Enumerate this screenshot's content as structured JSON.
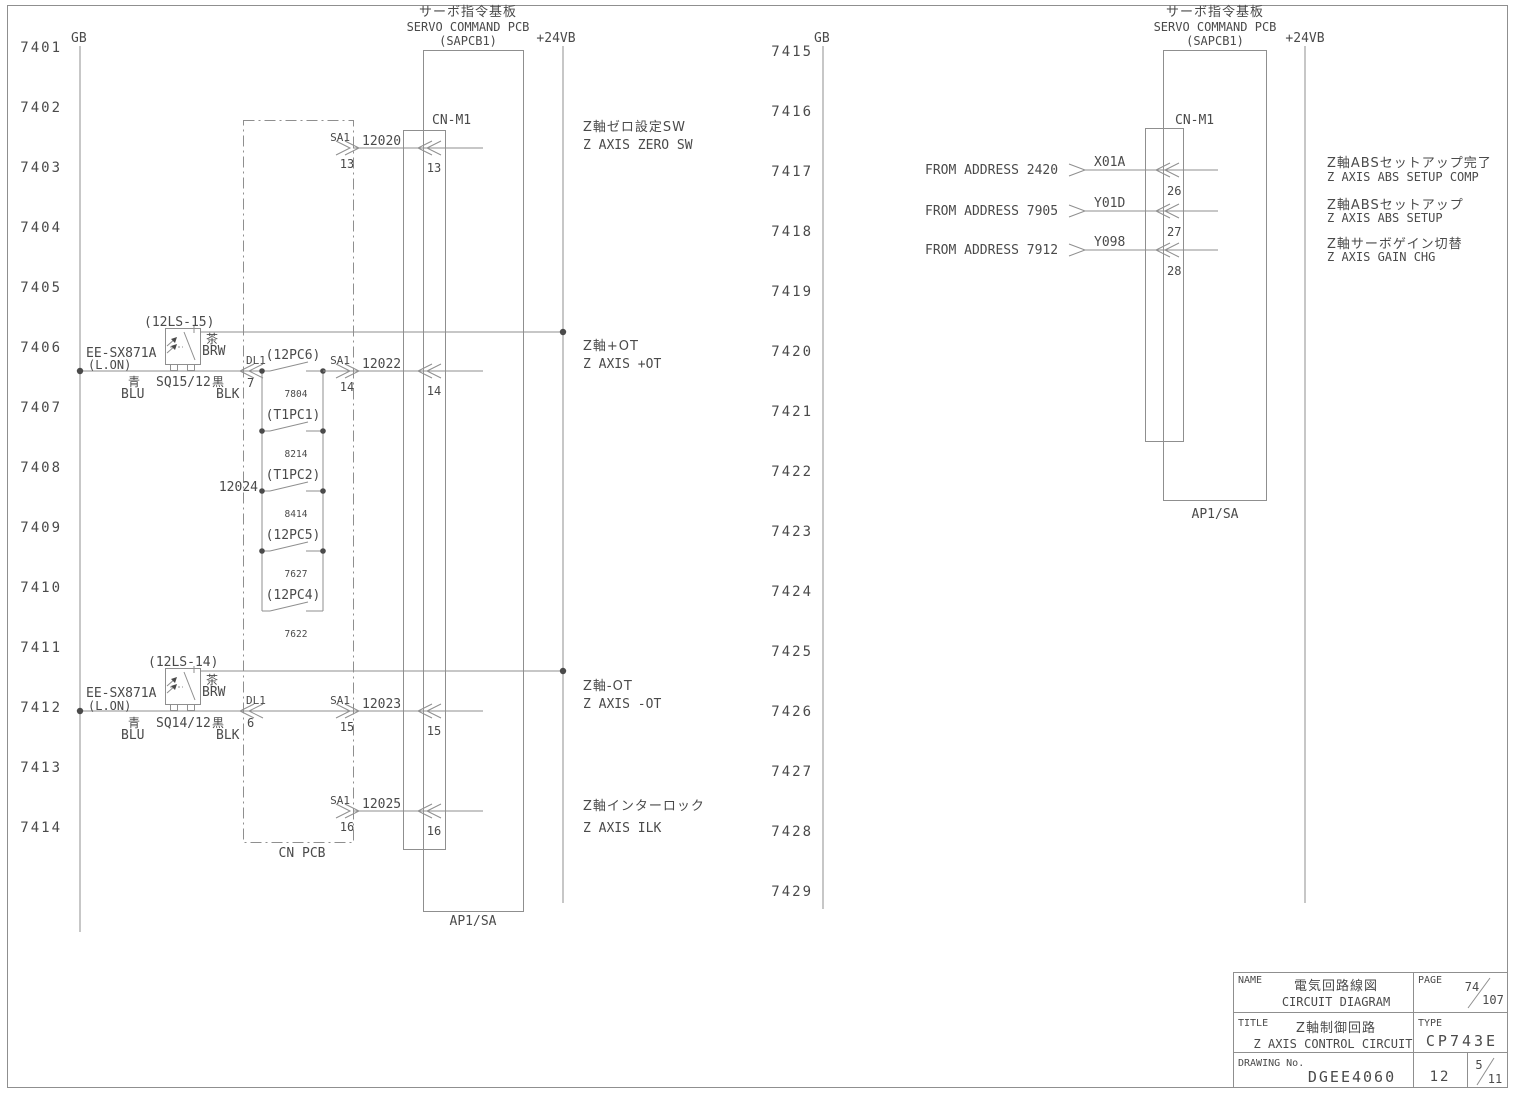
{
  "drawing": {
    "left_rows": [
      "7401",
      "7402",
      "7403",
      "7404",
      "7405",
      "7406",
      "7407",
      "7408",
      "7409",
      "7410",
      "7411",
      "7412",
      "7413",
      "7414"
    ],
    "right_rows": [
      "7415",
      "7416",
      "7417",
      "7418",
      "7419",
      "7420",
      "7421",
      "7422",
      "7423",
      "7424",
      "7425",
      "7426",
      "7427",
      "7428",
      "7429"
    ],
    "gb_label": "GB",
    "v24_label": "+24VB",
    "pcb_title_jp": "サーボ指令基板",
    "pcb_title_en": "SERVO COMMAND PCB",
    "pcb_title_sub": "(SAPCB1)",
    "connector_label": "CN-M1",
    "pcb_bottom_label": "AP1/SA",
    "cn_pcb_label": "CN PCB",
    "colors": {
      "line": "#8f8f8f",
      "text": "#4a4a4a"
    }
  },
  "left": {
    "signals": [
      {
        "conn": "SA1",
        "pin": "13",
        "wire": "12020",
        "cn_pin": "13",
        "label_jp": "Z軸ゼロ設定SW",
        "label_en": "Z AXIS ZERO SW"
      },
      {
        "conn": "SA1",
        "pin": "14",
        "wire": "12022",
        "cn_pin": "14",
        "label_jp": "Z軸+OT",
        "label_en": "Z AXIS +OT"
      },
      {
        "conn": "SA1",
        "pin": "15",
        "wire": "12023",
        "cn_pin": "15",
        "label_jp": "Z軸-OT",
        "label_en": "Z AXIS -OT"
      },
      {
        "conn": "SA1",
        "pin": "16",
        "wire": "12025",
        "cn_pin": "16",
        "label_jp": "Z軸インターロック",
        "label_en": "Z AXIS ILK"
      }
    ],
    "sensors": [
      {
        "ref": "(12LS-15)",
        "model": "EE-SX871A",
        "mode": "(L.ON)",
        "brown_jp": "茶",
        "brown": "BRW",
        "blue_jp": "青",
        "blue": "BLU",
        "tag": "SQ15/12",
        "black_jp": "黒",
        "black": "BLK",
        "conn": "DL1",
        "pin": "7"
      },
      {
        "ref": "(12LS-14)",
        "model": "EE-SX871A",
        "mode": "(L.ON)",
        "brown_jp": "茶",
        "brown": "BRW",
        "blue_jp": "青",
        "blue": "BLU",
        "tag": "SQ14/12",
        "black_jp": "黒",
        "black": "BLK",
        "conn": "DL1",
        "pin": "6"
      }
    ],
    "contacts": [
      {
        "label": "(12PC6)",
        "num": "7804"
      },
      {
        "label": "(T1PC1)",
        "num": "8214"
      },
      {
        "label": "(T1PC2)",
        "num": "8414"
      },
      {
        "label": "(12PC5)",
        "num": "7627"
      },
      {
        "label": "(12PC4)",
        "num": "7622"
      }
    ],
    "branch_wire": "12024"
  },
  "right": {
    "signals": [
      {
        "from": "FROM ADDRESS 2420",
        "wire": "X01A",
        "pin": "26",
        "label_jp": "Z軸ABSセットアップ完了",
        "label_en": "Z AXIS ABS SETUP COMP"
      },
      {
        "from": "FROM ADDRESS 7905",
        "wire": "Y01D",
        "pin": "27",
        "label_jp": "Z軸ABSセットアップ",
        "label_en": "Z AXIS ABS SETUP"
      },
      {
        "from": "FROM ADDRESS 7912",
        "wire": "Y098",
        "pin": "28",
        "label_jp": "Z軸サーボゲイン切替",
        "label_en": "Z AXIS GAIN CHG"
      }
    ]
  },
  "title_block": {
    "name_label": "NAME",
    "name_jp": "電気回路線図",
    "name_en": "CIRCUIT DIAGRAM",
    "page_label": "PAGE",
    "page_num": "74",
    "page_total": "107",
    "title_label": "TITLE",
    "title_jp": "Z軸制御回路",
    "title_en": "Z AXIS CONTROL CIRCUIT",
    "type_label": "TYPE",
    "type_value": "CP743E",
    "drawing_label": "DRAWING No.",
    "drawing_no": "DGEE4060",
    "sheet_no": "12",
    "rev_num": "5",
    "rev_total": "11"
  }
}
